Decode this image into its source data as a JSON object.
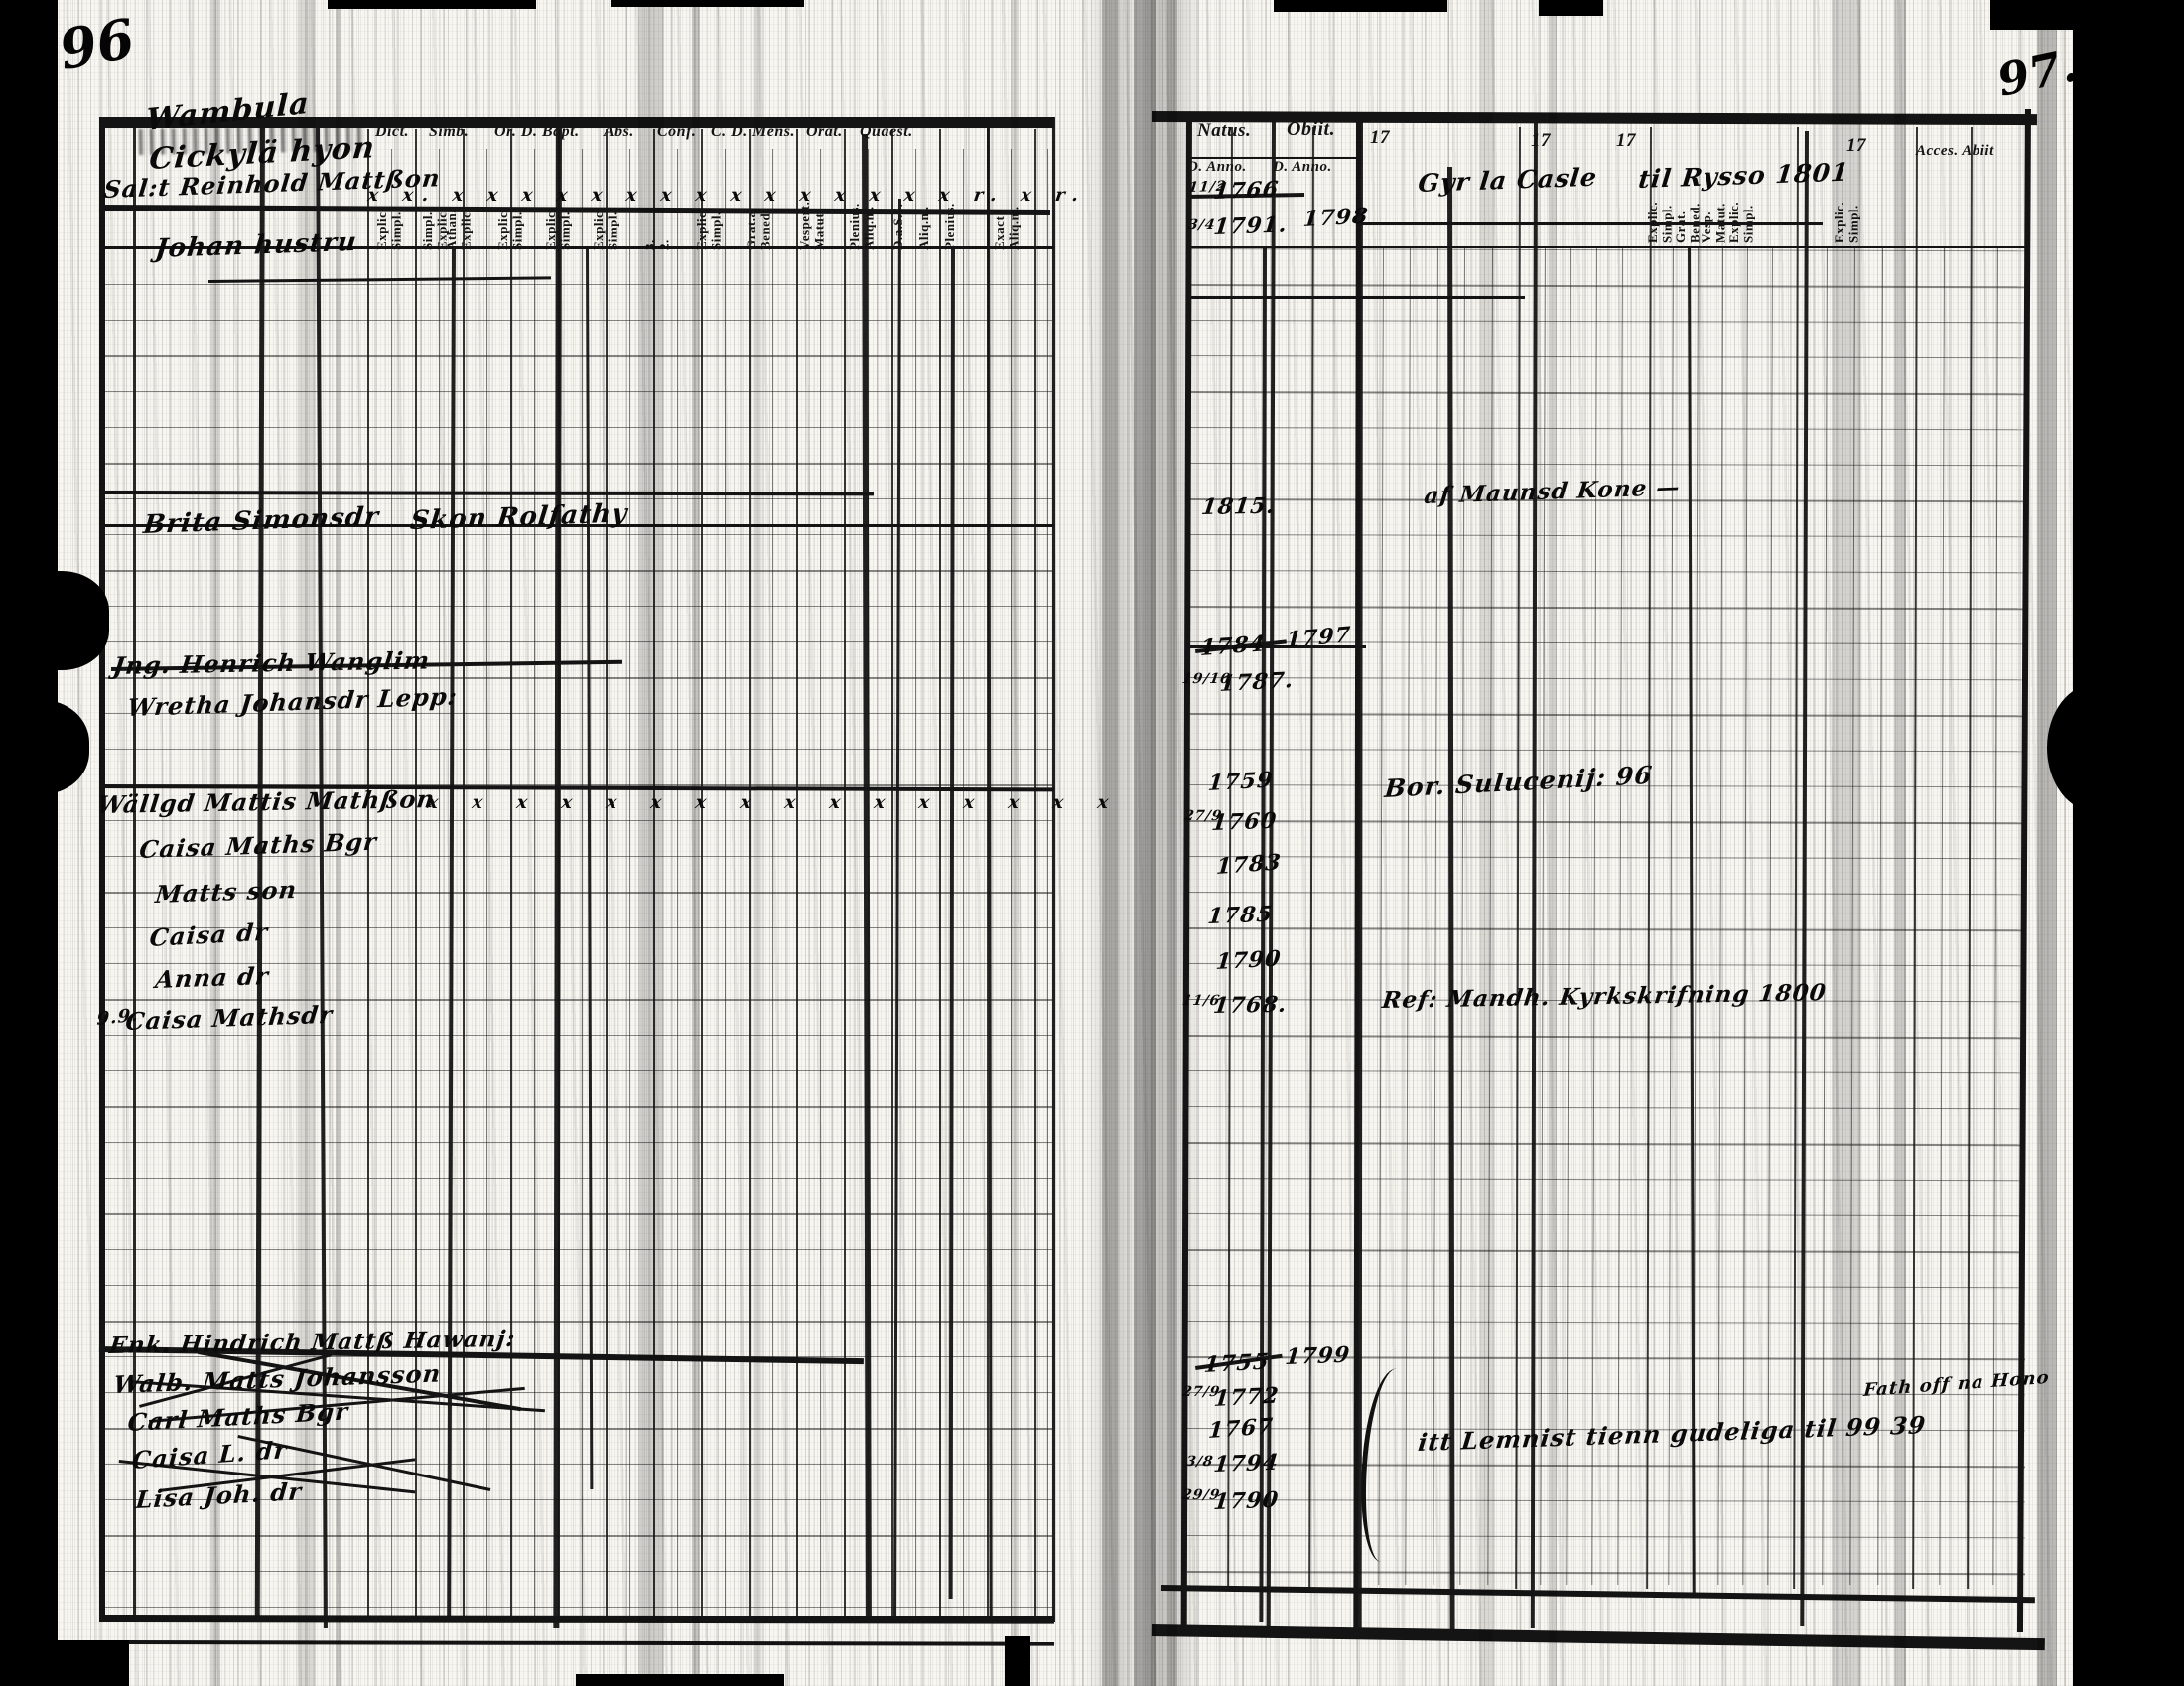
{
  "folios": {
    "left": "96",
    "right": "97."
  },
  "left_page": {
    "printed_columns": [
      "Dict.",
      "Simb.",
      "Or. D. Bapt.",
      "Abs.",
      "Conf.",
      "C. D.",
      "Mens.",
      "Orat.",
      "Quaest."
    ],
    "printed_subcolumns": [
      "Explic. Simpl.",
      "Simpl. Explic.",
      "Athan. Explic.",
      "Explic. Simpl.",
      "Explic. Simpl.",
      "Explic. Simpl.",
      "3. 2.",
      "Explic. Simpl.",
      "Grat.a Bened.",
      "Vespert. Matut.",
      "Plenius. Aliq.m.",
      "D.a.S.S.",
      "Aliq.m.",
      "Plenius.",
      "Exact Aliq.m."
    ],
    "handwritten": [
      "Wambula",
      "Cickylä hyon",
      "Sal:t Reinhold Mattßon",
      "x x. x x x x x x x x x x x x x x x r. x r.",
      "Johan hustru",
      "Brita Simonsdr",
      "Skon Rolfathy",
      "Jng. Henrich Wanglim",
      "Wretha Johansdr Lepp:",
      "Wällgd Mattis Mathßon",
      "x x x x x x x x x x x x x x x x",
      "Caisa Maths Bgr",
      "Matts son",
      "Caisa dr",
      "Anna dr",
      "Caisa Mathsdr",
      "9.9.",
      "Enk. Hindrich Mattß Hawanj:",
      "Walb. Matts Johansson",
      "Carl Maths Bgr",
      "Caisa L. dr",
      "Lisa Joh. dr"
    ]
  },
  "right_page": {
    "printed_columns": [
      "Natus.",
      "Obiit.",
      "17",
      "17",
      "17",
      "17"
    ],
    "printed_subcolumns": [
      "D. Anno.",
      "D. Anno."
    ],
    "printed_vertical_labels": [
      "Explic. Simpl.",
      "Grat. Bened.",
      "Vesp. Matut.",
      "Explic. Simpl.",
      "Explic. Simpl."
    ],
    "printed_corner": "Acces. Abiit",
    "handwritten": [
      "11/2",
      "1766",
      "Gyr la Casle",
      "til Rysso 1801",
      "3/4",
      "1791.",
      "1798",
      "1815.",
      "af Maunsd Kone —",
      "1784",
      "1797",
      "19/10",
      "1787.",
      "1759",
      "Bor. Sulucenij: 96",
      "27/9",
      "1760",
      "1783",
      "1785",
      "1790",
      "11/6",
      "1768.",
      "Ref: Mandh. Kyrkskrifning 1800",
      "1755",
      "1799",
      "27/9",
      "1772",
      "1767",
      "Fath off na Hono",
      "3/8",
      "1794",
      "itt Lemnist tienn gudeliga til 99 39",
      "29/9",
      "1790"
    ]
  }
}
